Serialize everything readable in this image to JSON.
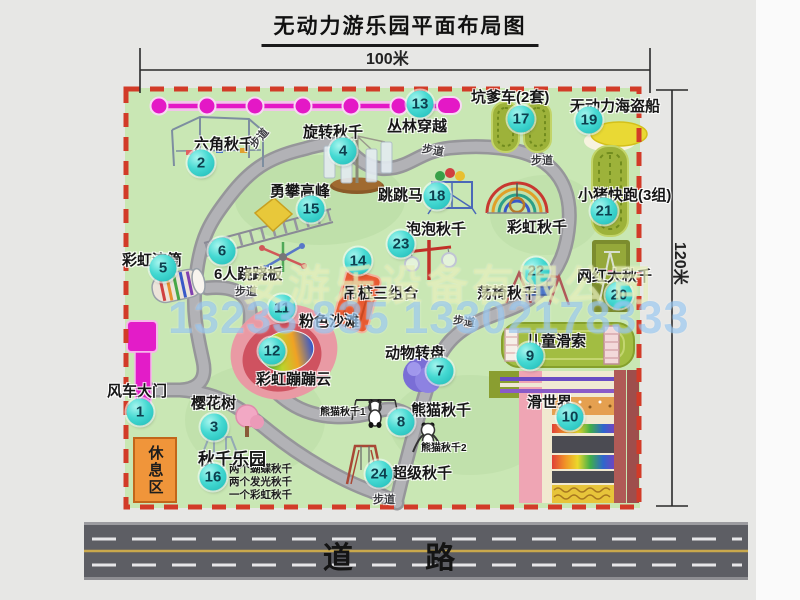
{
  "title": "无动力游乐园平面布局图",
  "dimensions": {
    "width": "100米",
    "height": "120米"
  },
  "road_label": "道 路",
  "watermark": {
    "company": "安游乐设备有限公司",
    "phone": "13233 835 13302178333"
  },
  "rest_area_label": "休息区",
  "swing_park_notes": [
    "两个蝴蝶秋千",
    "两个发光秋千",
    "一个彩虹秋千"
  ],
  "attractions": [
    {
      "num": 1,
      "name": "风车大门",
      "badge": {
        "x": 140,
        "y": 412
      },
      "label": {
        "x": 107,
        "y": 380
      }
    },
    {
      "num": 2,
      "name": "六角秋千",
      "badge": {
        "x": 201,
        "y": 163
      },
      "label": {
        "x": 194,
        "y": 133
      }
    },
    {
      "num": 3,
      "name": "樱花树",
      "badge": {
        "x": 214,
        "y": 427
      },
      "label": {
        "x": 191,
        "y": 392
      }
    },
    {
      "num": 4,
      "name": "旋转秋千",
      "badge": {
        "x": 343,
        "y": 151
      },
      "label": {
        "x": 303,
        "y": 121
      }
    },
    {
      "num": 5,
      "name": "彩虹滚筒",
      "badge": {
        "x": 163,
        "y": 268
      },
      "label": {
        "x": 122,
        "y": 249
      }
    },
    {
      "num": 6,
      "name": "6人跷跷板",
      "badge": {
        "x": 222,
        "y": 251
      },
      "label": {
        "x": 214,
        "y": 263
      }
    },
    {
      "num": 7,
      "name": "动物转盘",
      "badge": {
        "x": 440,
        "y": 371
      },
      "label": {
        "x": 385,
        "y": 342
      }
    },
    {
      "num": 8,
      "name": "熊猫秋千",
      "badge": {
        "x": 401,
        "y": 422
      },
      "label": {
        "x": 411,
        "y": 399
      }
    },
    {
      "num": 9,
      "name": "儿童滑索",
      "badge": {
        "x": 530,
        "y": 356
      },
      "label": {
        "x": 526,
        "y": 330
      }
    },
    {
      "num": 10,
      "name": "滑世界",
      "badge": {
        "x": 570,
        "y": 417
      },
      "label": {
        "x": 527,
        "y": 391
      }
    },
    {
      "num": 11,
      "name": "粉色沙滩",
      "badge": {
        "x": 282,
        "y": 308
      },
      "label": {
        "x": 299,
        "y": 310
      }
    },
    {
      "num": 12,
      "name": "彩虹蹦蹦云",
      "badge": {
        "x": 272,
        "y": 351
      },
      "label": {
        "x": 256,
        "y": 368
      }
    },
    {
      "num": 13,
      "name": "丛林穿越",
      "badge": {
        "x": 420,
        "y": 104
      },
      "label": {
        "x": 387,
        "y": 115
      }
    },
    {
      "num": 14,
      "name": "吊桩三组合",
      "badge": {
        "x": 358,
        "y": 261
      },
      "label": {
        "x": 343,
        "y": 282
      }
    },
    {
      "num": 15,
      "name": "勇攀高峰",
      "badge": {
        "x": 311,
        "y": 209
      },
      "label": {
        "x": 270,
        "y": 180
      }
    },
    {
      "num": 16,
      "name": "秋千乐园",
      "badge": {
        "x": 213,
        "y": 477
      },
      "label": {
        "x": 198,
        "y": 445,
        "size": 17
      }
    },
    {
      "num": 17,
      "name": "坑爹车(2套)",
      "badge": {
        "x": 521,
        "y": 119
      },
      "label": {
        "x": 471,
        "y": 86
      }
    },
    {
      "num": 18,
      "name": "跳跳马",
      "badge": {
        "x": 437,
        "y": 196
      },
      "label": {
        "x": 378,
        "y": 184
      }
    },
    {
      "num": 19,
      "name": "无动力海盗船",
      "badge": {
        "x": 589,
        "y": 120
      },
      "label": {
        "x": 570,
        "y": 95
      }
    },
    {
      "num": 20,
      "name": "网红大秋千",
      "badge": {
        "x": 619,
        "y": 295
      },
      "label": {
        "x": 577,
        "y": 265
      }
    },
    {
      "num": 21,
      "name": "小猪快跑(3组)",
      "badge": {
        "x": 604,
        "y": 211
      },
      "label": {
        "x": 578,
        "y": 184
      }
    },
    {
      "num": 22,
      "name": "荡椅秋千",
      "badge": {
        "x": 536,
        "y": 271
      },
      "label": {
        "x": 477,
        "y": 282
      }
    },
    {
      "num": 23,
      "name": "泡泡秋千",
      "badge": {
        "x": 401,
        "y": 244
      },
      "label": {
        "x": 406,
        "y": 218
      }
    },
    {
      "num": 24,
      "name": "超级秋千",
      "badge": {
        "x": 379,
        "y": 474
      },
      "label": {
        "x": 392,
        "y": 462
      }
    }
  ],
  "extra_labels": [
    {
      "text": "彩虹秋千",
      "x": 507,
      "y": 216,
      "size": 15
    },
    {
      "text": "熊猫秋千1",
      "x": 320,
      "y": 403,
      "size": 10
    },
    {
      "text": "熊猫秋千2",
      "x": 421,
      "y": 439,
      "size": 10
    }
  ],
  "path_labels": [
    {
      "text": "步道",
      "x": 248,
      "y": 130,
      "rot": -50
    },
    {
      "text": "步道",
      "x": 422,
      "y": 142,
      "rot": 10
    },
    {
      "text": "步道",
      "x": 531,
      "y": 152,
      "rot": 0
    },
    {
      "text": "步道",
      "x": 235,
      "y": 283,
      "rot": 0
    },
    {
      "text": "步道",
      "x": 453,
      "y": 313,
      "rot": 8
    },
    {
      "text": "步道",
      "x": 373,
      "y": 491,
      "rot": 0
    }
  ]
}
